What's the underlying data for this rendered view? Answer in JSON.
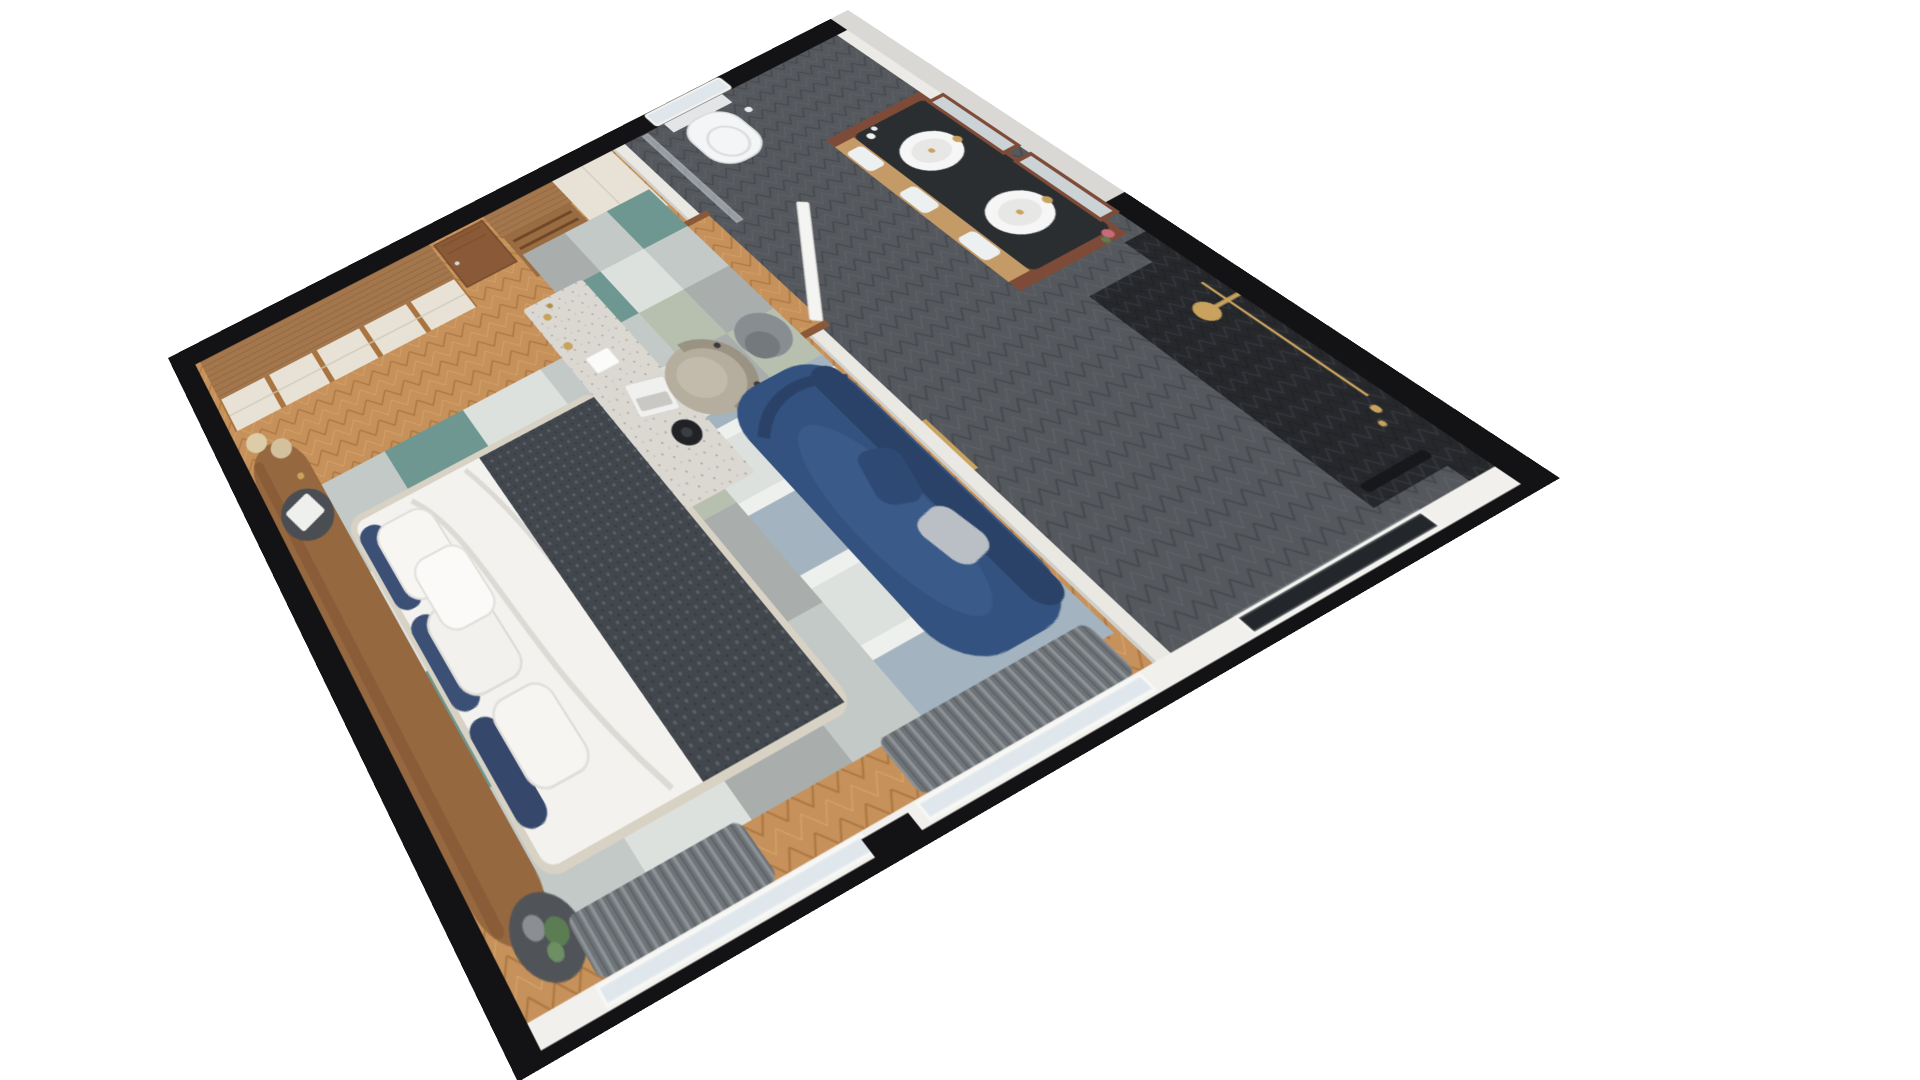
{
  "meta": {
    "image_type": "3d-floor-plan-render",
    "view": "perspective top-down (dollhouse cutaway)",
    "background": "#ffffff",
    "rooms": [
      "bedroom",
      "bathroom"
    ]
  },
  "palette": {
    "wall-black": "#131315",
    "wall-gray": "#d9d8d5",
    "partition": "#e9e8e3",
    "partition-edge": "#cfcec9",
    "floor-wood": "#c6915a",
    "wood-dark": "#a9743f",
    "wood-light": "#d8a76e",
    "wardrobe-top": "#a3764c",
    "wardrobe-grain": "#8f6440",
    "cream": "#e7e2d5",
    "cream-line": "#cfc9ba",
    "door-wood": "#8a5a38",
    "headboard": "#96683f",
    "bed-white": "#f3f2ef",
    "bed-shadow": "#dcdad5",
    "bed-frame": "#d8d2c4",
    "throw": "#41474c",
    "throw-knit": "#59616a",
    "pillow-blue": "#3c5076",
    "rug-silver": "#c3c9c7",
    "rug-teal": "#6f9791",
    "rug-gray": "#a9aeac",
    "rug-sage": "#b7c0af",
    "rug-pale": "#dde1de",
    "rug-blue": "#a3b3c0",
    "rug-white": "#eef0ed",
    "desk-top": "#dbd8d2",
    "desk-wood": "#a8794f",
    "chair": "#b5ad9d",
    "chair-dark": "#9a9283",
    "sofa": "#34527f",
    "sofa-dark": "#2a4268",
    "table-gray": "#878d91",
    "bath-floor": "#55595e",
    "bath-floor-line": "#45484d",
    "tile-dark": "#26282c",
    "tile-dark-line": "#35383d",
    "vanity-wood": "#7e4b38",
    "counter": "#2b2e31",
    "sink": "#f6f6f6",
    "gold": "#c9a35e",
    "towel": "#edf0f1",
    "shelf-wood": "#c49a66",
    "toilet": "#f4f5f6",
    "glass": "#ccd3d8",
    "curtain": "#6e7378",
    "curtain-light": "#8d9297",
    "window-glass": "#dfe7ec",
    "window-dark": "#23262b",
    "sill": "#f1f0ec",
    "plant": "#5c7d54",
    "marble": "#efefed",
    "speaker": "#202225",
    "laptop": "#f0f0ef",
    "bg": "#ffffff"
  },
  "scene": {
    "bedroom": {
      "floor": "oak herringbone parquet",
      "items": [
        "wardrobe-with-cream-doors",
        "entry-door",
        "luggage-rack-niche",
        "linen-cabinet",
        "curved-wood-headboard-panel",
        "double-bed",
        "white-duvet",
        "dark-knit-throw",
        "white-pillows",
        "navy-pillows",
        "round-nightstand-with-tray",
        "round-nightstand-with-plant",
        "patchwork-rug-under-bed",
        "patchwork-rug-lounge",
        "writing-desk",
        "desk-lamp",
        "laptop",
        "round-speaker",
        "barrel-chair",
        "navy-chaise-sofa",
        "sofa-pillows",
        "round-side-table",
        "window-with-curtain-left",
        "window-with-curtain-right",
        "cream-poufs",
        "wall-sconces"
      ]
    },
    "bathroom": {
      "floor": "gray chevron tile",
      "items": [
        "wall-hung-toilet",
        "toilet-window",
        "glass-screen",
        "double-vanity",
        "black-countertop",
        "oval-sink-left",
        "oval-sink-right",
        "gold-faucets",
        "framed-mirrors",
        "towel-shelf",
        "white-towels",
        "flowers",
        "walk-in-shower",
        "dark-chevron-tile-wall",
        "gold-shower-set",
        "dark-window",
        "bathroom-door"
      ]
    }
  }
}
